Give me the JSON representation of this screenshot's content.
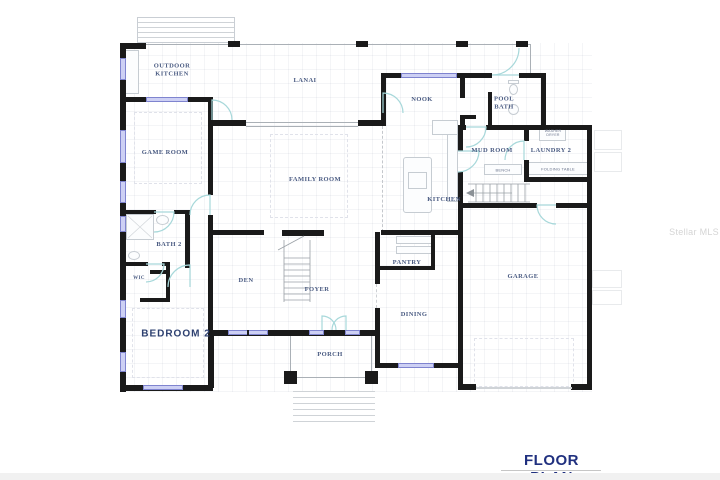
{
  "title": "FLOOR PLAN",
  "watermark": "Stellar MLS",
  "rooms": {
    "outdoor_kitchen": "OUTDOOR\nKITCHEN",
    "lanai": "LANAI",
    "nook": "NOOK",
    "pool_bath": "POOL\nBATH",
    "game_room": "GAME ROOM",
    "mud_room": "MUD ROOM",
    "laundry": "LAUNDRY 2",
    "family_room": "FAMILY ROOM",
    "kitchen": "KITCHEN",
    "bath2": "BATH 2",
    "wic": "WIC",
    "den": "DEN",
    "foyer": "FOYER",
    "pantry": "PANTRY",
    "dining": "DINING",
    "garage": "GARAGE",
    "bedroom2": "BEDROOM 2",
    "porch": "PORCH"
  },
  "annotations": {
    "bench": "BENCH",
    "folding_table": "FOLDING TABLE",
    "washer_dryer": "WASHER\nDRYER"
  },
  "colors": {
    "wall": "#1a1a1a",
    "window": "#cdd0f4",
    "window_border": "#7f84cf",
    "door_arc": "#a7d8da",
    "room_label": "#4a5b82",
    "bedroom_label": "#2d4070",
    "title": "#20307f",
    "watermark": "#d5d5d5",
    "fixture": "#c6ccd2",
    "stairs": "#8b9196"
  }
}
